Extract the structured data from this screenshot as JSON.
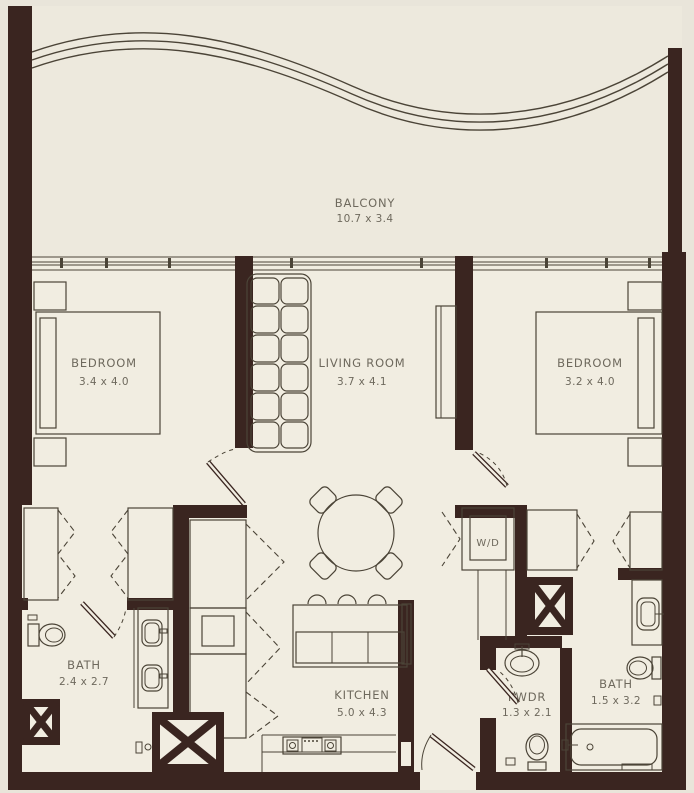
{
  "rooms": {
    "balcony": {
      "name": "BALCONY",
      "dims": "10.7 x 3.4"
    },
    "bedroom1": {
      "name": "BEDROOM",
      "dims": "3.4 x 4.0"
    },
    "living_room": {
      "name": "LIVING ROOM",
      "dims": "3.7 x 4.1"
    },
    "bedroom2": {
      "name": "BEDROOM",
      "dims": "3.2 x 4.0"
    },
    "bath1": {
      "name": "BATH",
      "dims": "2.4 x 2.7"
    },
    "kitchen": {
      "name": "KITCHEN",
      "dims": "5.0 x 4.3"
    },
    "powder_room": {
      "name": "PWDR",
      "dims": "1.3 x 2.1"
    },
    "bath2": {
      "name": "BATH",
      "dims": "1.5 x 3.2"
    },
    "washer_dryer": {
      "name": "W/D"
    }
  },
  "colors": {
    "wall": "#3a2520",
    "furniture_line": "#4b4437",
    "floor": "#f1ede1",
    "balcony_floor": "#ede9dd",
    "background": "#e9e5da",
    "label_text": "#6e695d"
  }
}
